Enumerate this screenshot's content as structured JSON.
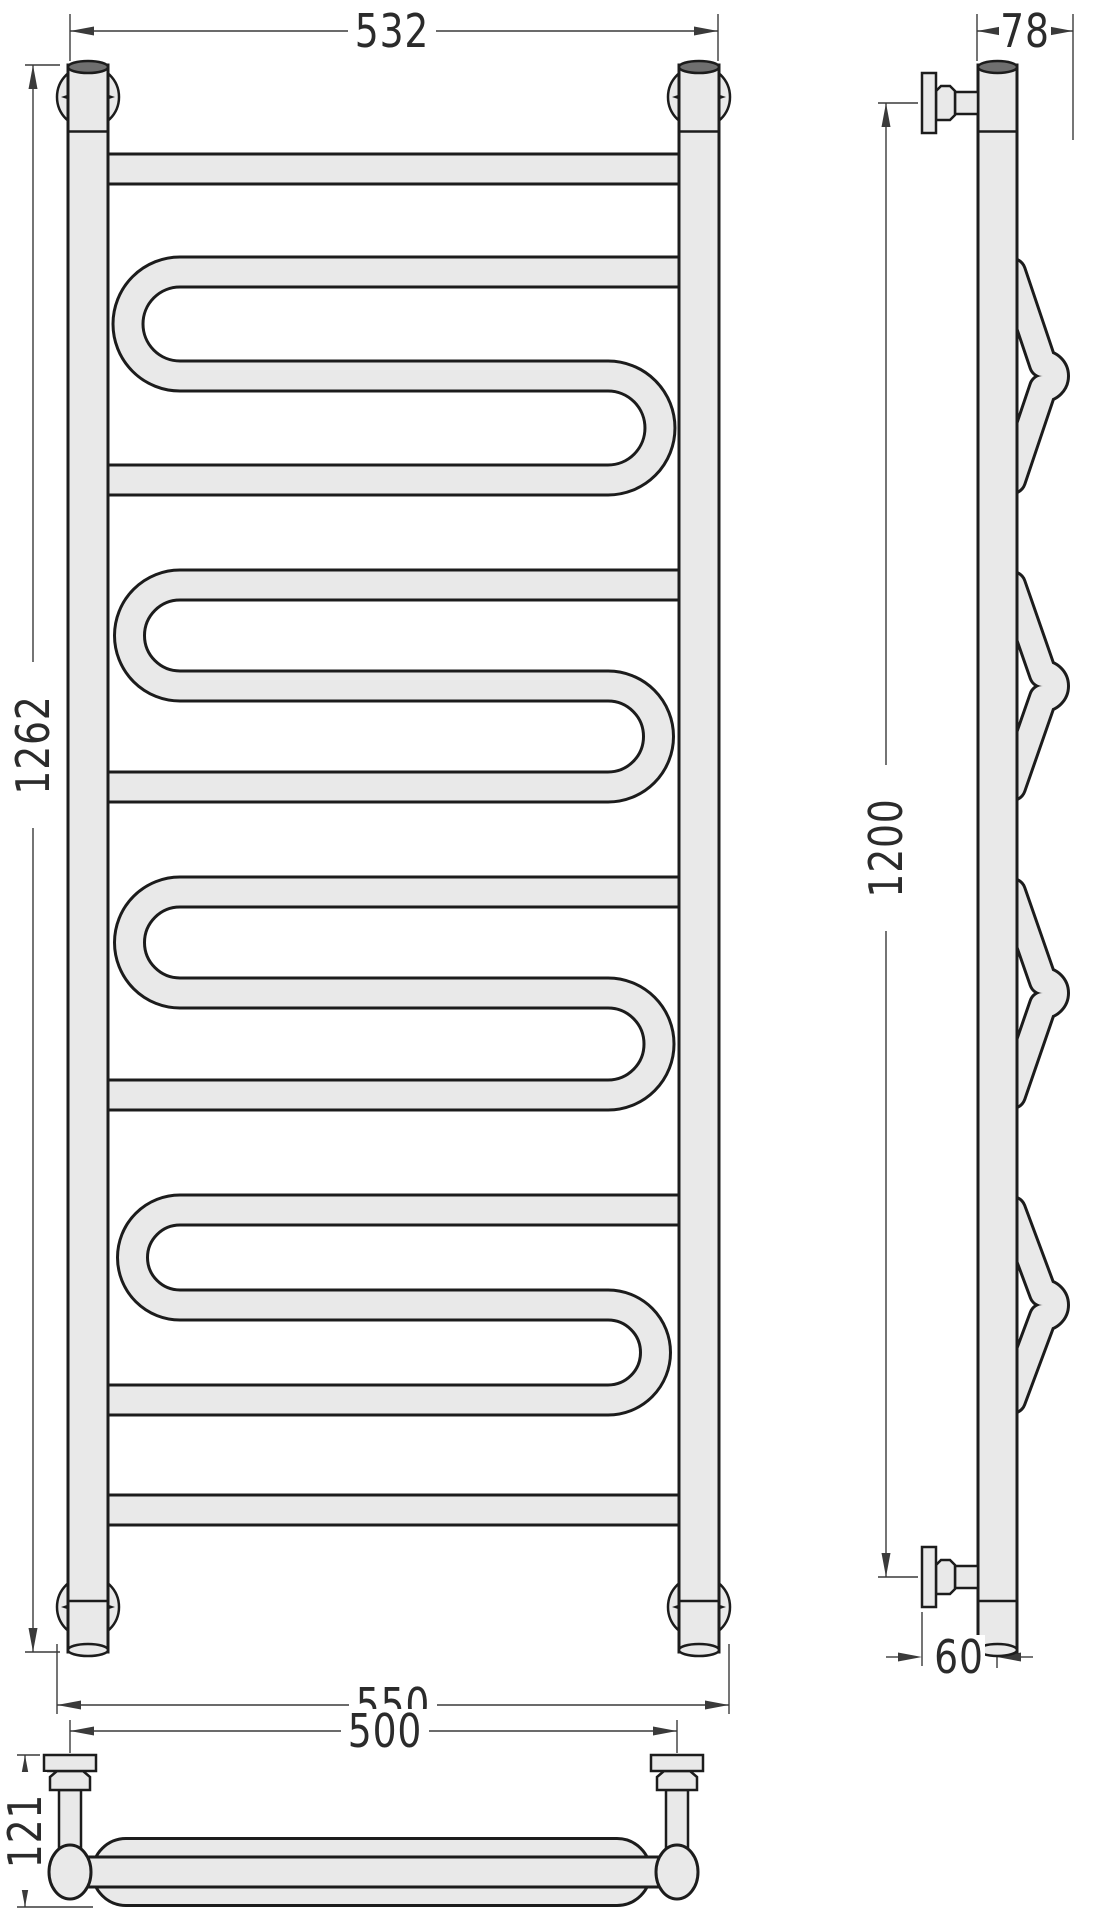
{
  "drawing": {
    "type": "technical-drawing",
    "subject": "ladder-towel-rail-with-serpentine-coils",
    "views": {
      "front": "front-view",
      "side": "side-view",
      "top": "top-view"
    },
    "dimensions": {
      "top_width": {
        "label": "532",
        "orientation": "horizontal"
      },
      "side_depth": {
        "label": "78",
        "orientation": "horizontal"
      },
      "overall_height": {
        "label": "1262",
        "orientation": "vertical"
      },
      "mounting_height": {
        "label": "1200",
        "orientation": "vertical"
      },
      "bottom_width": {
        "label": "550",
        "orientation": "horizontal"
      },
      "mounting_width": {
        "label": "500",
        "orientation": "horizontal"
      },
      "top_view_depth": {
        "label": "121",
        "orientation": "vertical"
      },
      "wall_offset": {
        "label": "60",
        "orientation": "horizontal"
      }
    },
    "counts": {
      "serpentine_coils": 4,
      "plain_rungs": 2,
      "mount_circles": 4,
      "wall_brackets": 4
    },
    "colors": {
      "tube_fill": "#e9e9e9",
      "outline": "#1c1c1c",
      "dimension": "#3a3a3a",
      "background": "#ffffff"
    }
  }
}
